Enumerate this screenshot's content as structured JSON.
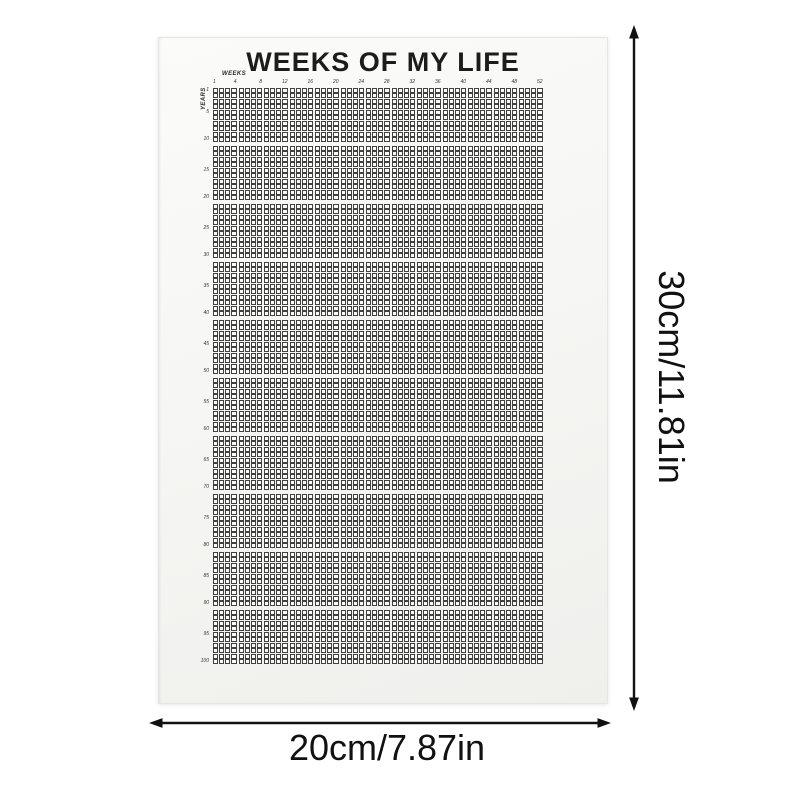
{
  "poster": {
    "title": "WEEKS OF MY LIFE",
    "weeks_axis_label": "WEEKS",
    "years_axis_label": "YEARS",
    "first_week_tick": "1",
    "week_ticks": [
      "4",
      "8",
      "12",
      "16",
      "20",
      "24",
      "28",
      "32",
      "36",
      "40",
      "44",
      "48",
      "52"
    ],
    "year_ticks": [
      "1",
      "5",
      "10",
      "15",
      "20",
      "25",
      "30",
      "35",
      "40",
      "45",
      "50",
      "55",
      "60",
      "65",
      "70",
      "75",
      "80",
      "85",
      "90",
      "95",
      "100"
    ],
    "grid": {
      "total_weeks": 52,
      "total_years": 100,
      "weeks_per_block": 4,
      "years_per_block": 10,
      "col_blocks": 13,
      "row_blocks": 10
    }
  },
  "dimension_annotations": {
    "height_label": "30cm/11.81in",
    "width_label": "20cm/7.87in"
  },
  "colors": {
    "poster_paper": "#f6f6f4",
    "grid_line": "#414141",
    "ink": "#111111",
    "title_ink": "#1c1c1c"
  }
}
